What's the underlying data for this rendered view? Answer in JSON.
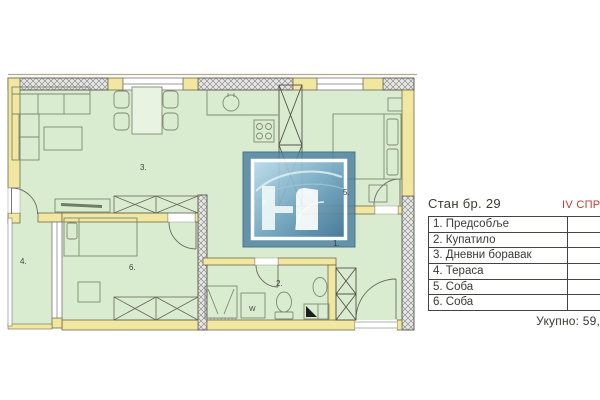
{
  "panel": {
    "title": "Стан бр. 29",
    "floor_label": "IV СПРАТ",
    "rooms": [
      {
        "name": "1. Предсобље",
        "area": "8,"
      },
      {
        "name": "2. Купатило",
        "area": "4,"
      },
      {
        "name": "3. Дневни боравак",
        "area": "23,"
      },
      {
        "name": "4. Тераса",
        "area": "3,"
      },
      {
        "name": "5. Соба",
        "area": "10,"
      },
      {
        "name": "6. Соба",
        "area": "9,"
      }
    ],
    "total_label": "Укупно: 59,"
  },
  "plan": {
    "labels": {
      "hall": "1.",
      "bathroom": "2.",
      "living": "3.",
      "terrace": "4.",
      "bedroom1": "5.",
      "bedroom2": "6.",
      "washing_machine": "W",
      "watermark_letter": "F"
    },
    "colors": {
      "room_fill": "#daecd0",
      "wall_yellow": "#f2e7a0",
      "accent_red": "#c23a2c",
      "watermark_blue": "#4d81a2"
    }
  }
}
